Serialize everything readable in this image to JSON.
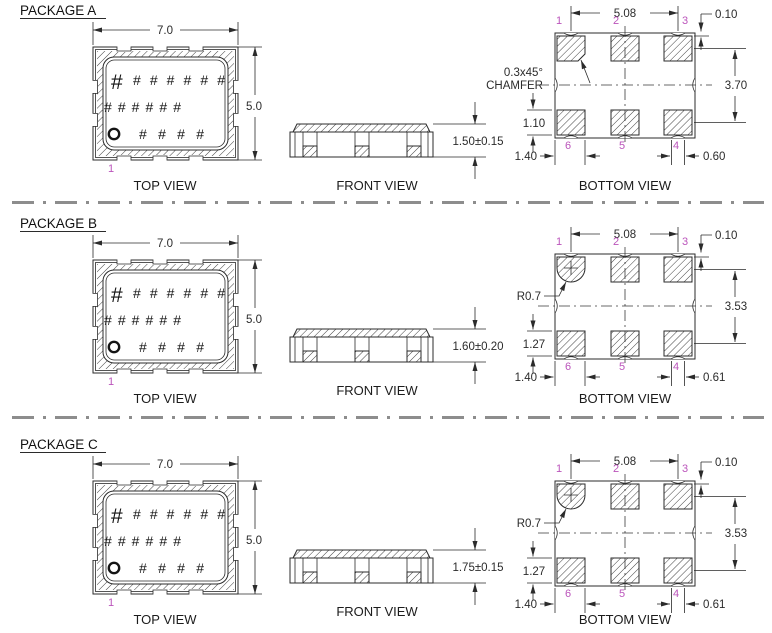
{
  "drawing": {
    "type": "package-mechanical-drawing",
    "units_note": "",
    "colors": {
      "ink": "#2b2b2b",
      "pin_number": "#bb54bb",
      "separator": "#8d8d8d",
      "background": "#ffffff"
    }
  },
  "packages": [
    {
      "title": "PACKAGE A",
      "top_view": {
        "caption": "TOP VIEW",
        "body_width_dim": "7.0",
        "body_height_dim": "5.0",
        "pin1_label": "1",
        "marking_hash_large": "#",
        "marking_row1": "# # # # # #",
        "marking_row2": "# # # # # #",
        "marking_row3": "# # # #"
      },
      "front_view": {
        "caption": "FRONT VIEW",
        "height_dim": "1.50±0.15"
      },
      "bottom_view": {
        "caption": "BOTTOM VIEW",
        "pad_pitch_dim": "5.08",
        "edge_offset_dim": "0.10",
        "row_pitch_dim": "3.70",
        "pad_height_dim": "1.10",
        "corner_pad_dim": "1.40",
        "notch_width_dim": "0.60",
        "feature_label_line1": "0.3x45°",
        "feature_label_line2": "CHAMFER",
        "pins_top": [
          "1",
          "2",
          "3"
        ],
        "pins_bottom": [
          "6",
          "5",
          "4"
        ]
      }
    },
    {
      "title": "PACKAGE B",
      "top_view": {
        "caption": "TOP VIEW",
        "body_width_dim": "7.0",
        "body_height_dim": "5.0",
        "pin1_label": "1",
        "marking_hash_large": "#",
        "marking_row1": "# # # # # #",
        "marking_row2": "# # # # # #",
        "marking_row3": "# # # #"
      },
      "front_view": {
        "caption": "FRONT VIEW",
        "height_dim": "1.60±0.20"
      },
      "bottom_view": {
        "caption": "BOTTOM VIEW",
        "pad_pitch_dim": "5.08",
        "edge_offset_dim": "0.10",
        "row_pitch_dim": "3.53",
        "pad_height_dim": "1.27",
        "corner_pad_dim": "1.40",
        "notch_width_dim": "0.61",
        "feature_label_line1": "R0.7",
        "feature_label_line2": "",
        "pins_top": [
          "1",
          "2",
          "3"
        ],
        "pins_bottom": [
          "6",
          "5",
          "4"
        ]
      }
    },
    {
      "title": "PACKAGE C",
      "top_view": {
        "caption": "TOP VIEW",
        "body_width_dim": "7.0",
        "body_height_dim": "5.0",
        "pin1_label": "1",
        "marking_hash_large": "#",
        "marking_row1": "# # # # # #",
        "marking_row2": "# # # # # #",
        "marking_row3": "# # # #"
      },
      "front_view": {
        "caption": "FRONT VIEW",
        "height_dim": "1.75±0.15"
      },
      "bottom_view": {
        "caption": "BOTTOM VIEW",
        "pad_pitch_dim": "5.08",
        "edge_offset_dim": "0.10",
        "row_pitch_dim": "3.53",
        "pad_height_dim": "1.27",
        "corner_pad_dim": "1.40",
        "notch_width_dim": "0.61",
        "feature_label_line1": "R0.7",
        "feature_label_line2": "",
        "pins_top": [
          "1",
          "2",
          "3"
        ],
        "pins_bottom": [
          "6",
          "5",
          "4"
        ]
      }
    }
  ]
}
